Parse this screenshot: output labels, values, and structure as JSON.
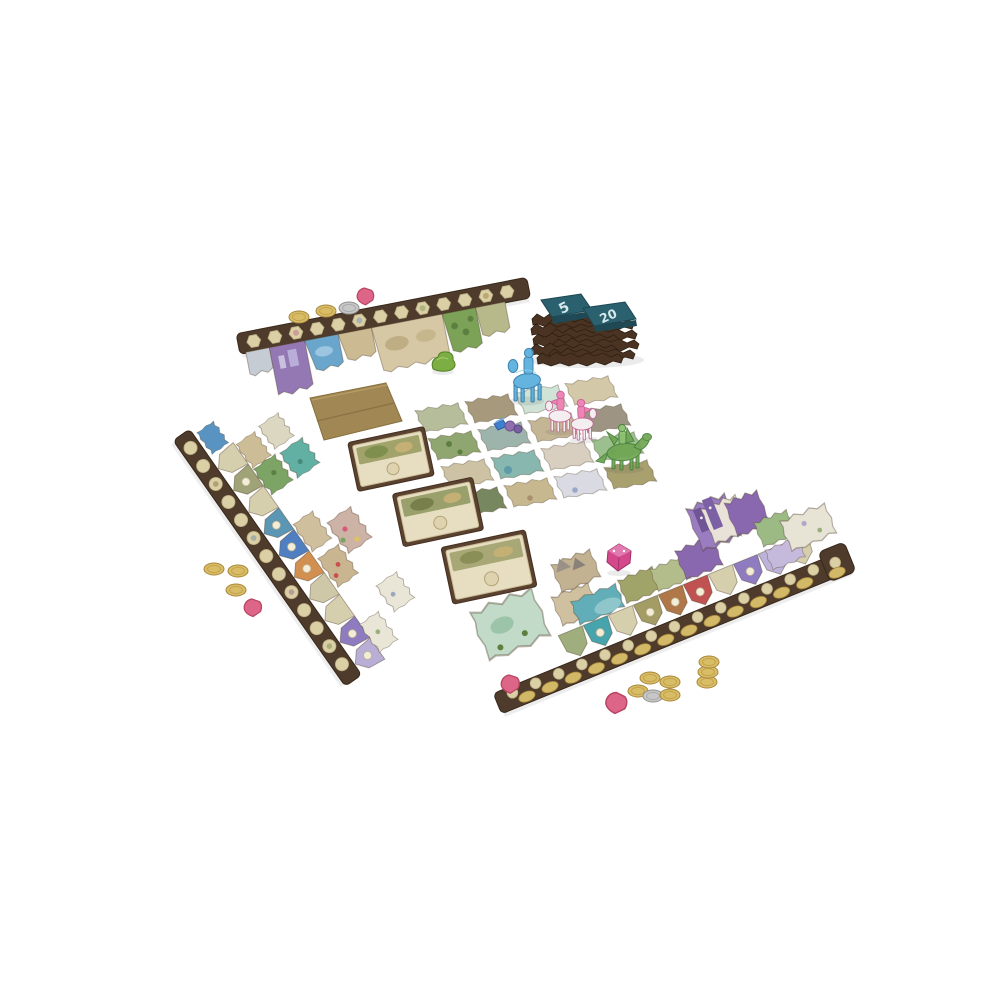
{
  "scene": {
    "description": "Product photo of a fantasy board game set up for play on a white studio background: three long jagged scoring strips with terrain tiles, a 4x4 grid of square terrain tiles with translucent rider figures, three bonus cards, a kraft cardboard panel, two stacks of scoring tiles, coins, pink gems and a crystal die",
    "background_color": "#ffffff"
  },
  "score_tile_stacks": {
    "stack_count": 2,
    "left_label": "5",
    "right_label": "20",
    "tile_color": "#2b616e",
    "number_color": "#d5e9ec",
    "stack_color": "#4a3322"
  },
  "player_strips": [
    {
      "id": "top",
      "track_color": "#4e3b2b",
      "space_shape": "hexagon",
      "space_count": 13,
      "terrain_tile_count": 8
    },
    {
      "id": "left",
      "track_color": "#4e3b2b",
      "space_shape": "circle",
      "space_count": 13,
      "pentagon_tile_count": 10
    },
    {
      "id": "bottom-right",
      "track_color": "#4e3b2b",
      "space_shape": "circle-and-gold-oval",
      "space_count": 15,
      "pentagon_tile_count": 10
    }
  ],
  "center_tile_grid": {
    "rows": 4,
    "cols": 4,
    "tile_colors": [
      "#b6bd9a",
      "#a79a7c",
      "#cfe3d6",
      "#d3c8a8",
      "#8fa671",
      "#9db4ad",
      "#c4b694",
      "#9d9484",
      "#cdc3a4",
      "#87b7ae",
      "#d8cfc0",
      "#9cbf8e",
      "#77875f",
      "#c8b88f",
      "#d9dae2",
      "#a9a06f"
    ]
  },
  "figures": [
    {
      "name": "blue rider",
      "color": "#57aedd"
    },
    {
      "name": "pink rider",
      "color": "#ee85b5"
    },
    {
      "name": "pink rider",
      "color": "#ee85b5"
    },
    {
      "name": "green dragon rider",
      "color": "#6fa653"
    }
  ],
  "cards": {
    "count": 3,
    "border_color": "#5a4130",
    "face_color": "#e7dec2",
    "art_color": "#a2a26b"
  },
  "tokens": {
    "gold_coins": 12,
    "silver_coins": 2,
    "pink_gems": 4,
    "crystal_die_color": "#d4488c",
    "gold_color": "#d9bd66",
    "silver_color": "#c7c7c7",
    "gem_color": "#dd6587",
    "green_marker_color": "#7cae44"
  },
  "cardboard_panel": {
    "color": "#a18754"
  }
}
